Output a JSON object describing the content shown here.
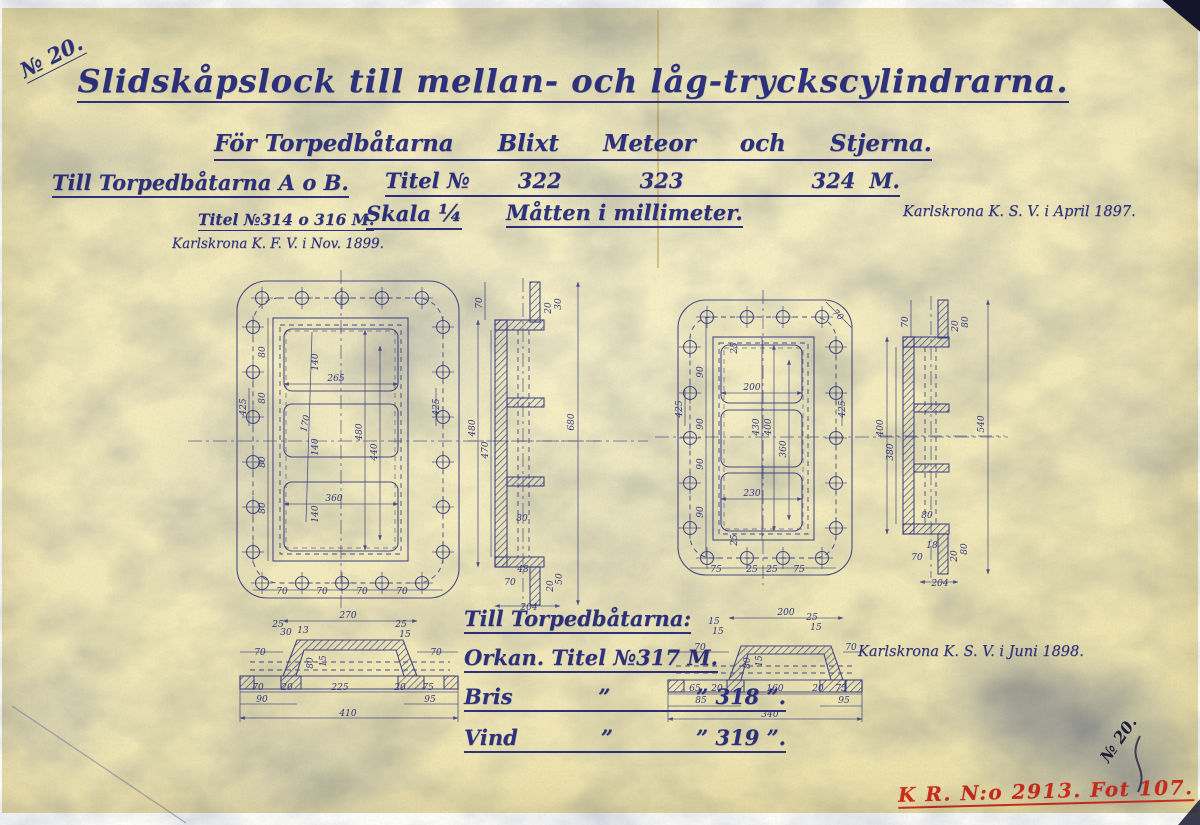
{
  "page": {
    "paper_color": "#f0e7b6",
    "ink_color": "#2f337e",
    "line_color": "#3c4287",
    "stamp_color": "#ce2d1c",
    "corner_number_top": "№ 20.",
    "corner_number_bottom": "№ 20.",
    "stamp": "K R. N:o 2913. Fot 107."
  },
  "header": {
    "title": "Slidskåpslock till mellan- och låg-tryckscylindrarna.",
    "subtitle_parts": [
      "För Torpedbåtarna",
      "Blixt",
      "Meteor",
      "och",
      "Stjerna."
    ],
    "row3_left": "Till Torpedbåtarna A o B.",
    "titel_label": "Titel №",
    "titel_numbers": [
      "322",
      "323",
      "324"
    ],
    "titel_m": "M.",
    "row4_titel": "Titel №314 o 316 M.",
    "skala_label": "Skala",
    "skala_value": "¼",
    "matt": "Måtten i millimeter.",
    "note_1897": "Karlskrona K. S. V. i April 1897.",
    "note_1899": "Karlskrona K. F. V. i Nov. 1899."
  },
  "footer": {
    "till": "Till Torpedbåtarna:",
    "orkan": "Orkan. Titel №317 M.",
    "rows": [
      {
        "name": "Bris",
        "q": "”",
        "num": "” 318 ”."
      },
      {
        "name": "Vind",
        "q": "”",
        "num": "” 319 ”."
      }
    ],
    "note_1898": "Karlskrona K. S. V. i Juni 1898."
  },
  "views": {
    "left_plan": {
      "labels": [
        {
          "t": "265",
          "x": 336,
          "y": 381
        },
        {
          "t": "360",
          "x": 334,
          "y": 501
        },
        {
          "t": "140",
          "x": 318,
          "y": 362,
          "r": -90
        },
        {
          "t": "140",
          "x": 318,
          "y": 447,
          "r": -90
        },
        {
          "t": "140",
          "x": 318,
          "y": 514,
          "r": -90
        },
        {
          "t": "480",
          "x": 362,
          "y": 432,
          "r": -90
        },
        {
          "t": "440",
          "x": 377,
          "y": 452,
          "r": -90
        },
        {
          "t": "170",
          "x": 308,
          "y": 424,
          "r": -78
        },
        {
          "t": "80",
          "x": 265,
          "y": 352,
          "r": -90
        },
        {
          "t": "80",
          "x": 265,
          "y": 398,
          "r": -90
        },
        {
          "t": "80",
          "x": 265,
          "y": 462,
          "r": -90
        },
        {
          "t": "80",
          "x": 265,
          "y": 508,
          "r": -90
        },
        {
          "t": "425",
          "x": 246,
          "y": 407,
          "r": -90
        },
        {
          "t": "425",
          "x": 439,
          "y": 407,
          "r": -90
        },
        {
          "t": "70",
          "x": 282,
          "y": 594
        },
        {
          "t": "70",
          "x": 322,
          "y": 594
        },
        {
          "t": "70",
          "x": 362,
          "y": 594
        },
        {
          "t": "70",
          "x": 402,
          "y": 594
        }
      ]
    },
    "left_section": {
      "labels": [
        {
          "t": "70",
          "x": 482,
          "y": 303,
          "r": -90
        },
        {
          "t": "20",
          "x": 551,
          "y": 308,
          "r": -90
        },
        {
          "t": "30",
          "x": 561,
          "y": 304,
          "r": -90
        },
        {
          "t": "480",
          "x": 475,
          "y": 428,
          "r": -90
        },
        {
          "t": "470",
          "x": 488,
          "y": 450,
          "r": -90
        },
        {
          "t": "680",
          "x": 574,
          "y": 422,
          "r": -90
        },
        {
          "t": "80",
          "x": 522,
          "y": 521
        },
        {
          "t": "48",
          "x": 523,
          "y": 572
        },
        {
          "t": "70",
          "x": 510,
          "y": 585
        },
        {
          "t": "20",
          "x": 553,
          "y": 586,
          "r": -90
        },
        {
          "t": "50",
          "x": 562,
          "y": 579,
          "r": -90
        },
        {
          "t": "204",
          "x": 529,
          "y": 610
        }
      ]
    },
    "right_plan": {
      "labels": [
        {
          "t": "200",
          "x": 752,
          "y": 390
        },
        {
          "t": "230",
          "x": 752,
          "y": 496
        },
        {
          "t": "430",
          "x": 759,
          "y": 427,
          "r": -90
        },
        {
          "t": "400",
          "x": 771,
          "y": 427,
          "r": -90
        },
        {
          "t": "360",
          "x": 786,
          "y": 449,
          "r": -90
        },
        {
          "t": "90",
          "x": 703,
          "y": 372,
          "r": -90
        },
        {
          "t": "90",
          "x": 703,
          "y": 424,
          "r": -90
        },
        {
          "t": "90",
          "x": 703,
          "y": 464,
          "r": -90
        },
        {
          "t": "90",
          "x": 703,
          "y": 512,
          "r": -90
        },
        {
          "t": "25",
          "x": 737,
          "y": 348,
          "r": -90
        },
        {
          "t": "25",
          "x": 737,
          "y": 540,
          "r": -90
        },
        {
          "t": "425",
          "x": 682,
          "y": 409,
          "r": -90
        },
        {
          "t": "425",
          "x": 845,
          "y": 409,
          "r": -90
        },
        {
          "t": "70",
          "x": 836,
          "y": 317,
          "r": 42
        },
        {
          "t": "75",
          "x": 716,
          "y": 572
        },
        {
          "t": "25",
          "x": 752,
          "y": 572
        },
        {
          "t": "25",
          "x": 772,
          "y": 572
        },
        {
          "t": "75",
          "x": 799,
          "y": 572
        }
      ]
    },
    "right_section": {
      "labels": [
        {
          "t": "70",
          "x": 908,
          "y": 322,
          "r": -90
        },
        {
          "t": "20",
          "x": 958,
          "y": 326,
          "r": -90
        },
        {
          "t": "80",
          "x": 968,
          "y": 322,
          "r": -90
        },
        {
          "t": "400",
          "x": 883,
          "y": 428,
          "r": -90
        },
        {
          "t": "380",
          "x": 893,
          "y": 452,
          "r": -90
        },
        {
          "t": "540",
          "x": 984,
          "y": 424,
          "r": -90
        },
        {
          "t": "80",
          "x": 927,
          "y": 518
        },
        {
          "t": "18",
          "x": 932,
          "y": 548
        },
        {
          "t": "70",
          "x": 917,
          "y": 560
        },
        {
          "t": "20",
          "x": 957,
          "y": 556,
          "r": -90
        },
        {
          "t": "80",
          "x": 967,
          "y": 549,
          "r": -90
        },
        {
          "t": "204",
          "x": 940,
          "y": 586
        }
      ]
    },
    "bottom_left_section": {
      "labels": [
        {
          "t": "270",
          "x": 348,
          "y": 618
        },
        {
          "t": "25",
          "x": 278,
          "y": 627
        },
        {
          "t": "30",
          "x": 286,
          "y": 635
        },
        {
          "t": "13",
          "x": 303,
          "y": 633
        },
        {
          "t": "25",
          "x": 401,
          "y": 627
        },
        {
          "t": "15",
          "x": 405,
          "y": 637
        },
        {
          "t": "70",
          "x": 260,
          "y": 655
        },
        {
          "t": "70",
          "x": 436,
          "y": 655
        },
        {
          "t": "80",
          "x": 313,
          "y": 663,
          "r": -90
        },
        {
          "t": "15",
          "x": 326,
          "y": 661,
          "r": -90
        },
        {
          "t": "70",
          "x": 258,
          "y": 690
        },
        {
          "t": "20",
          "x": 287,
          "y": 690
        },
        {
          "t": "225",
          "x": 340,
          "y": 690
        },
        {
          "t": "20",
          "x": 400,
          "y": 690
        },
        {
          "t": "75",
          "x": 428,
          "y": 690
        },
        {
          "t": "90",
          "x": 262,
          "y": 702
        },
        {
          "t": "95",
          "x": 430,
          "y": 702
        },
        {
          "t": "410",
          "x": 348,
          "y": 716
        }
      ]
    },
    "bottom_right_section": {
      "labels": [
        {
          "t": "200",
          "x": 786,
          "y": 615
        },
        {
          "t": "15",
          "x": 714,
          "y": 624
        },
        {
          "t": "15",
          "x": 718,
          "y": 634
        },
        {
          "t": "25",
          "x": 812,
          "y": 620
        },
        {
          "t": "15",
          "x": 816,
          "y": 630
        },
        {
          "t": "70",
          "x": 700,
          "y": 650
        },
        {
          "t": "70",
          "x": 851,
          "y": 650
        },
        {
          "t": "80",
          "x": 750,
          "y": 663,
          "r": -90
        },
        {
          "t": "15",
          "x": 762,
          "y": 661,
          "r": -90
        },
        {
          "t": "65",
          "x": 695,
          "y": 691
        },
        {
          "t": "20",
          "x": 717,
          "y": 691
        },
        {
          "t": "160",
          "x": 775,
          "y": 691
        },
        {
          "t": "20",
          "x": 818,
          "y": 691
        },
        {
          "t": "75",
          "x": 841,
          "y": 691
        },
        {
          "t": "85",
          "x": 701,
          "y": 703
        },
        {
          "t": "95",
          "x": 844,
          "y": 703
        },
        {
          "t": "340",
          "x": 770,
          "y": 717
        }
      ]
    }
  }
}
